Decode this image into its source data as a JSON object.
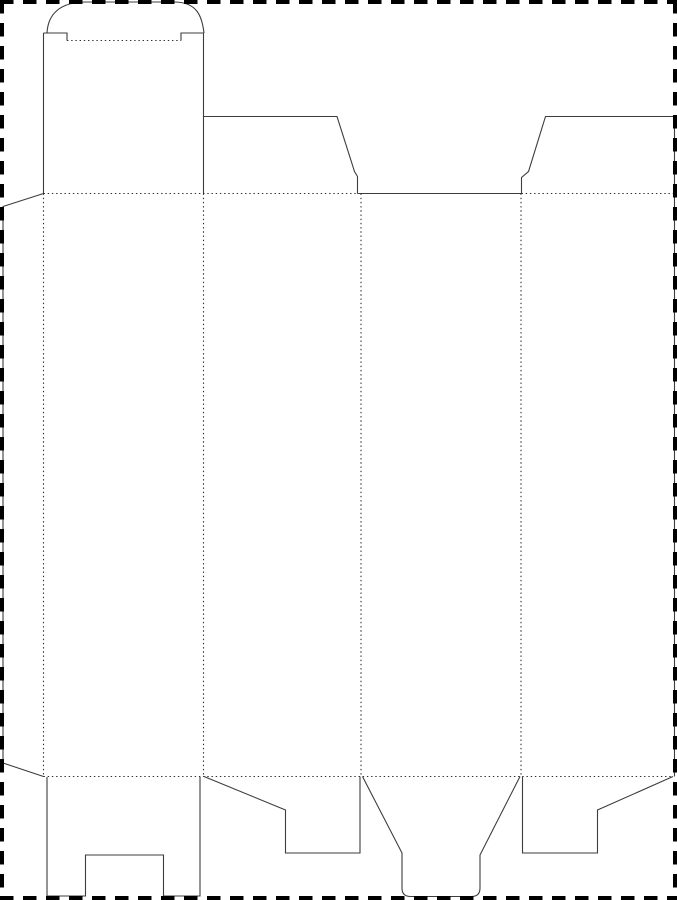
{
  "page": {
    "background": "#ffffff",
    "width": 677,
    "height": 900
  },
  "diagram": {
    "kind": "packaging-dieline",
    "description": "Flat die-cut template for a folding carton: glue flap, four panels, tuck-top lid with domed tab, angled top dust flaps, and slotted bottom flaps. Solid = cut, dotted = fold, dashed frame = sheet edge.",
    "styles": {
      "cut_color": "#3d3d3d",
      "cut_width": 1.1,
      "fold_color": "#2e2e2e",
      "fold_width": 1.1,
      "fold_dash": "1.4 2.8",
      "border_color": "#000000",
      "border_width": 4,
      "border_dash": "13.5 9.5"
    },
    "cut_paths": [
      {
        "name": "glue-flap-outline",
        "d": "M 43.5 193.5 L 3 206.5 L 3 763 L 43.5 776.5"
      },
      {
        "name": "tuck-flap-left-edge",
        "d": "M 43.5 33 L 43.5 193.5"
      },
      {
        "name": "tuck-flap-right-edge",
        "d": "M 203.5 33 L 203.5 193.5"
      },
      {
        "name": "tuck-flap-shoulder-left",
        "d": "M 43.5 33 L 67 33 L 67 40.5"
      },
      {
        "name": "tuck-flap-shoulder-right",
        "d": "M 203.5 33 L 181 33 L 181 40.5"
      },
      {
        "name": "tuck-tab-arc",
        "d": "M 47 33 C 48 14 60 2 86 2 L 174 2 C 197 2 202 16 204 33"
      },
      {
        "name": "top-flap-2-outline",
        "d": "M 203.5 116.5 L 337 116.5 L 354.5 171.5 L 357.5 176.5 L 357.5 193.5"
      },
      {
        "name": "panel-3-top-edge",
        "d": "M 357.5 193.5 L 521.5 193.5"
      },
      {
        "name": "top-flap-4-outline",
        "d": "M 521.5 193.5 L 521.5 177.5 L 528.5 171.5 L 545.5 116.5 L 674.5 116.5"
      },
      {
        "name": "panel-4-right-edge",
        "d": "M 674.5 116.5 L 674.5 776.5"
      },
      {
        "name": "bottom-flap-1-outline",
        "d": "M 47 777 L 47 896 L 85.5 896 L 85.5 855 L 163.5 855 L 163.5 896 L 200 896 L 200 777"
      },
      {
        "name": "bottom-flap-2-outline",
        "d": "M 204 776.5 L 285.5 810 L 285.5 853 L 360 853 L 360 776.5"
      },
      {
        "name": "bottom-flap-3-outline",
        "d": "M 362.5 776.5 L 402 853 L 402 888 Q 402 896.5 410.5 896.5 L 471.5 896.5 Q 480 896.5 480 888 L 480 855 L 520 776.5"
      },
      {
        "name": "bottom-flap-4-outline",
        "d": "M 673 776.5 L 597.5 810 L 597.5 853 L 522.5 853 L 522.5 776.5"
      }
    ],
    "fold_paths": [
      {
        "name": "tuck-tab-fold",
        "d": "M 67 40.5 L 181 40.5"
      },
      {
        "name": "top-fold-left",
        "d": "M 43.5 193.5 L 357.5 193.5"
      },
      {
        "name": "top-fold-right",
        "d": "M 521.5 193.5 L 674.5 193.5"
      },
      {
        "name": "glue-panel-fold",
        "d": "M 43.5 193.5 L 43.5 776.5"
      },
      {
        "name": "panel-1-2-fold",
        "d": "M 203.5 193.5 L 203.5 776.5"
      },
      {
        "name": "panel-2-3-fold",
        "d": "M 361 193.5 L 361 776.5"
      },
      {
        "name": "panel-3-4-fold",
        "d": "M 521 193.5 L 521 776.5"
      },
      {
        "name": "bottom-fold",
        "d": "M 43.5 776.5 L 673 776.5"
      }
    ],
    "border_lines": [
      {
        "name": "sheet-border-top",
        "d": "M 0 2 L 677 2"
      },
      {
        "name": "sheet-border-right",
        "d": "M 675 0 L 675 900"
      },
      {
        "name": "sheet-border-bottom",
        "d": "M 0 898 L 677 898"
      },
      {
        "name": "sheet-border-left",
        "d": "M 2 0 L 2 900"
      }
    ]
  }
}
